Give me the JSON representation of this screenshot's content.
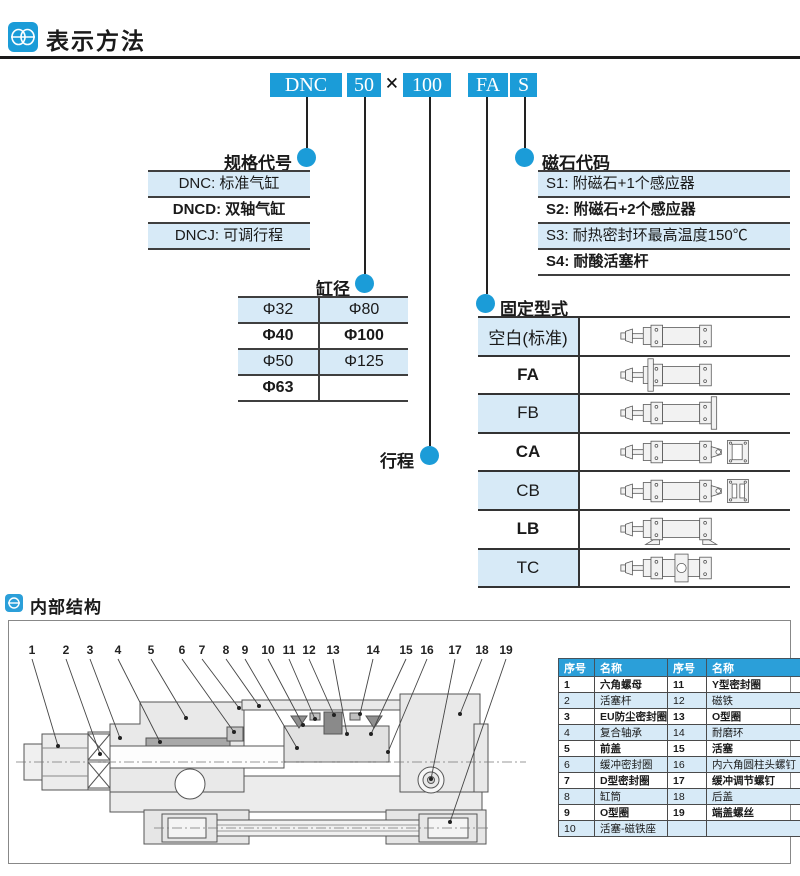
{
  "colors": {
    "accent": "#1b9cd8",
    "row_blue": "#d7eaf7",
    "header_blue": "#2b9fd9"
  },
  "page": {
    "section1_title": "表示方法",
    "section2_title": "内部结构"
  },
  "model_code": {
    "boxes": [
      "DNC",
      "50",
      "100",
      "FA",
      "S"
    ],
    "separator": "×"
  },
  "spec_code": {
    "title": "规格代号",
    "rows": [
      "DNC: 标准气缸",
      "DNCD: 双轴气缸",
      "DNCJ: 可调行程"
    ]
  },
  "bore": {
    "title": "缸径",
    "rows": [
      [
        "Φ32",
        "Φ80"
      ],
      [
        "Φ40",
        "Φ100"
      ],
      [
        "Φ50",
        "Φ125"
      ],
      [
        "Φ63",
        ""
      ]
    ]
  },
  "stroke": {
    "title": "行程"
  },
  "magnet": {
    "title": "磁石代码",
    "rows": [
      "S1: 附磁石+1个感应器",
      "S2: 附磁石+2个感应器",
      "S3: 耐热密封环最高温度150℃",
      "S4: 耐酸活塞杆"
    ]
  },
  "mounting": {
    "title": "固定型式",
    "rows": [
      {
        "label": "空白(标准)",
        "diagram": "cylinder-standard"
      },
      {
        "label": "FA",
        "diagram": "cylinder-front-flange"
      },
      {
        "label": "FB",
        "diagram": "cylinder-rear-flange"
      },
      {
        "label": "CA",
        "diagram": "cylinder-rear-clevis-a"
      },
      {
        "label": "CB",
        "diagram": "cylinder-rear-clevis-b"
      },
      {
        "label": "LB",
        "diagram": "cylinder-foot-mount"
      },
      {
        "label": "TC",
        "diagram": "cylinder-center-trunnion"
      }
    ]
  },
  "internal": {
    "callouts": [
      "1",
      "2",
      "3",
      "4",
      "5",
      "6",
      "7",
      "8",
      "9",
      "10",
      "11",
      "12",
      "13",
      "14",
      "15",
      "16",
      "17",
      "18",
      "19"
    ],
    "table": {
      "headers": [
        "序号",
        "名称",
        "序号",
        "名称"
      ],
      "rows": [
        [
          "1",
          "六角螺母",
          "11",
          "Y型密封圈"
        ],
        [
          "2",
          "活塞杆",
          "12",
          "磁铁"
        ],
        [
          "3",
          "EU防尘密封圈",
          "13",
          "O型圈"
        ],
        [
          "4",
          "复合轴承",
          "14",
          "耐磨环"
        ],
        [
          "5",
          "前盖",
          "15",
          "活塞"
        ],
        [
          "6",
          "缓冲密封圈",
          "16",
          "内六角圆柱头螺钉"
        ],
        [
          "7",
          "D型密封圈",
          "17",
          "缓冲调节螺钉"
        ],
        [
          "8",
          "缸筒",
          "18",
          "后盖"
        ],
        [
          "9",
          "O型圈",
          "19",
          "端盖螺丝"
        ],
        [
          "10",
          "活塞-磁铁座",
          "",
          ""
        ]
      ]
    }
  }
}
